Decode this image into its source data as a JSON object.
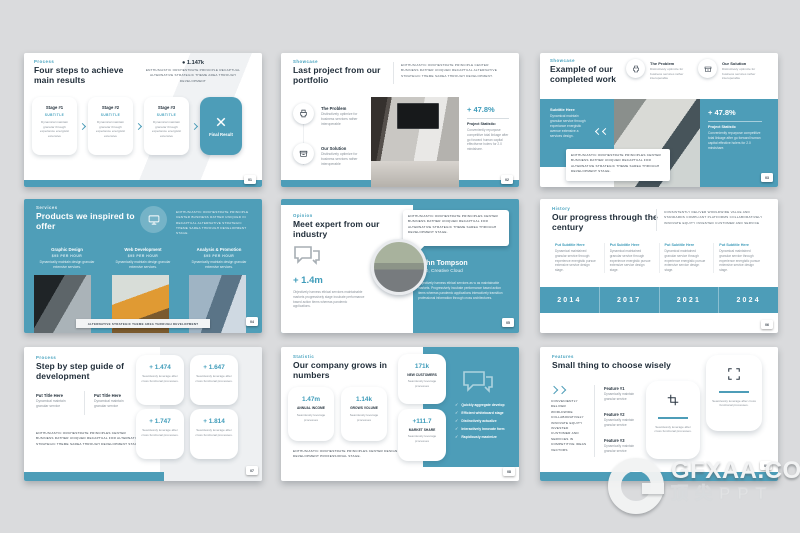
{
  "colors": {
    "accent": "#4d9db8",
    "title": "#212e3a",
    "background": "#dadbdd"
  },
  "watermark": {
    "brand": "GFXAA.COM",
    "sub": "顶尖PPT"
  },
  "glyphs": {
    "check": "✓",
    "bullet": "●"
  },
  "slides": {
    "s1": {
      "label": "Process",
      "title": "Four steps to achieve main results",
      "stat": "1.147k",
      "stat_desc": "ENTHUSIASTIC ORCHESTRATE PRINCIPLE RECAPTUAL ALTERNATIVE STRATEGIC THEME AREA THROUGH DEVELOPMENT",
      "stages": [
        {
          "name": "Stage #1",
          "subtitle": "Subtitle",
          "body": "Dynamical maintain granular through experiance energistic extensive"
        },
        {
          "name": "Stage #2",
          "subtitle": "Subtitle",
          "body": "Dynamical maintain granular through experiance energistic extensive"
        },
        {
          "name": "Stage #3",
          "subtitle": "Subtitle",
          "body": "Dynamical maintain granular through experiance energistic extensive"
        }
      ],
      "button": "Final Result",
      "page": "01"
    },
    "s2": {
      "label": "Showcase",
      "title": "Last project from our portfolio",
      "desc": "ENTHUSIASTIC ORCHESTRATE PRINCIPLE CENTER BUSINESS RATHER UNIQUED RECAPTUAL ALTERNATIVE STRATEGIC THEME SAREA THROUGH DEVELOPMENT.",
      "items": [
        {
          "title": "The Problem",
          "body": "Distinctively optimize for business services rather interoperable"
        },
        {
          "title": "Our Solution",
          "body": "Distinctively optimize for business services rather interoperable"
        }
      ],
      "stat": "+ 47.8%",
      "stat_title": "Project Statistic:",
      "stat_body": "Conveniently repurpose competitive total linkage after go forward human capital effectivene holers for 2.0 mindshare.",
      "page": "02"
    },
    "s3": {
      "label": "Showcase",
      "title": "Example of our completed work",
      "items": [
        {
          "title": "The Problem",
          "body": "Distinctively optimize for business services rather interoperable"
        },
        {
          "title": "Our Solution",
          "body": "Distinctively optimize for business services rather interoperable"
        }
      ],
      "subtitle_title": "Subtitle Here",
      "subtitle_body": "Dynamical maintain granular service through experiance energistic avenue extensive a services design.",
      "stat": "+ 47.8%",
      "stat_title": "Project Statistic",
      "stat_body": "Conveniently repurpose competitive total linkage after go forward human capital effective holers for 2.0 mindshare.",
      "note": "ENTHUSIASTIC ORCHESTRATE PRINCIPLES CENTER BUSINESS RATHER UNIQUED RECAPTUAL FOR ALTERNATIVE STRATEGIC THEME SAREA THROUGH DEVELOPMENT STAGE.",
      "page": "03"
    },
    "s4": {
      "label": "Services",
      "title": "Products we inspired to offer",
      "desc": "ENTHUSIASTIC ORCHESTRATE PRINCIPLE CENTER BUSINESS RATHER UNIQUED IN RECAPTUAL ALTERNATIVE STRATEGIC THEME SAREA THROUGH DEVELOPMENT STAGE.",
      "services": [
        {
          "name": "Graphic Design",
          "rate": "$95 per hour",
          "body": "Dynamically maintain design granular extensive services."
        },
        {
          "name": "Web Development",
          "rate": "$95 per hour",
          "body": "Dynamically maintain design granular extensive services."
        },
        {
          "name": "Analysis & Promotion",
          "rate": "$95 per hour",
          "body": "Dynamically maintain design granular extensive services."
        }
      ],
      "ribbon": "ALTERNATIVE STRATEGIC THEME AREA THROUGH DEVELOPMENT",
      "page": "04"
    },
    "s5": {
      "label": "Opinion",
      "title": "Meet expert from our industry",
      "stat": "+ 1.4m",
      "left_body": "Objectively harness ethical services maintainable markets progressively stage incubate performance based action items whereas pandemic applications.",
      "bubble": "ENTHUSIASTIC ORCHESTRATE PRINCIPLES CENTER BUSINESS RATHER UNIQUED RECAPTUAL FOR ALTERNATIVE STRATEGIC THEME SAREA THROUGH DEVELOPMENT STAGE.",
      "person_name": "John Tompson",
      "person_role": "CEO, Creative Cloud",
      "right_body": "Objectively harness ethical services as w as maintainable markets. Progressively incubate performance based action items whereas pandemic applications interactively transition professional information through cross architectures.",
      "page": "05"
    },
    "s6": {
      "label": "History",
      "title": "Our progress through the century",
      "desc": "CONSISTENTLY DELIVER WORLDWIDE VALUE AND STANDARDS COMPLIANT PLATFORMS COLLABORATIVELY INNOVATE EQUITY INVESTED CUSTOMER AND SERVICE",
      "columns": [
        {
          "subtitle": "Put Subtitle Here",
          "body": "Dynamical maintained granular service through experience energistic pursue extensive service design stage."
        },
        {
          "subtitle": "Put Subtitle Here",
          "body": "Dynamical maintained granular service through experience energistic pursue extensive service design stage."
        },
        {
          "subtitle": "Put Subtitle Here",
          "body": "Dynamical maintained granular service through experience energistic pursue extensive service design stage."
        },
        {
          "subtitle": "Put Subtitle Here",
          "body": "Dynamical maintained granular service through experience energistic pursue extensive service design stage."
        }
      ],
      "years": [
        "2014",
        "2017",
        "2021",
        "2024"
      ],
      "page": "06"
    },
    "s7": {
      "label": "Process",
      "title": "Step by step guide of development",
      "items": [
        {
          "title": "Put Title Here",
          "body": "Dynamical maintain granular service"
        },
        {
          "title": "Put Title Here",
          "body": "Dynamical maintain granular service"
        }
      ],
      "paragraph": "ENTHUSIASTIC ORCHESTRATE PRINCIPLES CENTER BUSINESS RATHER UNIQUED RECAPTUAL FOR ALTERNATIVE STRATEGIC THEME SAREA THROUGH DEVELOPMENT STAGE.",
      "cards": [
        {
          "value": "+ 1.474",
          "body": "Seamlessly leverage after cross functional processes."
        },
        {
          "value": "+ 1.647",
          "body": "Seamlessly leverage after cross functional processes."
        },
        {
          "value": "+ 1.747",
          "body": "Seamlessly leverage after cross functional processes."
        },
        {
          "value": "+ 1.814",
          "body": "Seamlessly leverage after cross functional processes."
        }
      ],
      "page": "07"
    },
    "s8": {
      "label": "Statistic",
      "title": "Our company grows in numbers",
      "stats": [
        {
          "value": "1.47m",
          "name": "ANNUAL INCOME",
          "body": "Seamlessly leverage processes"
        },
        {
          "value": "1.14k",
          "name": "GROWS VOLUME",
          "body": "Seamlessly leverage processes"
        },
        {
          "value": "171k",
          "name": "NEW CUSTOMERS",
          "body": "Seamlessly leverage processes"
        },
        {
          "value": "+111.7",
          "name": "MARKET SHARE",
          "body": "Seamlessly leverage processes"
        }
      ],
      "checklist": [
        "Quickly aggregate develop",
        "Efficient whiteboard stage",
        "Distinctively actualize",
        "Interactively innovate form",
        "Rapidiously maximize"
      ],
      "footer": "ENTHUSIASTIC ORCHESTRATE PRINCIPLES CENTER DESIGN DEVELOPMENT PROFESSIONAL STAGE.",
      "page": "08"
    },
    "s9": {
      "label": "Features",
      "title": "Small thing to choose wisely",
      "left_body": "CONVENIENTLY DELIVER WORLDWIDE COLLABORATIVELY INNOVATE EQUITY INVESTED CUSTOMER AND SERVICES IN COMPETITIVE IDEAS VECTORS",
      "features": [
        {
          "name": "Feature #1",
          "body": "Dynamically maintain granular service"
        },
        {
          "name": "Feature #2",
          "body": "Dynamically maintain granular service"
        },
        {
          "name": "Feature #3",
          "body": "Dynamically maintain granular service"
        }
      ],
      "cards": [
        {
          "body": "Seamlessly leverage after cross functional processes."
        },
        {
          "body": "Seamlessly leverage after cross functional processes."
        }
      ],
      "page": "09"
    }
  }
}
